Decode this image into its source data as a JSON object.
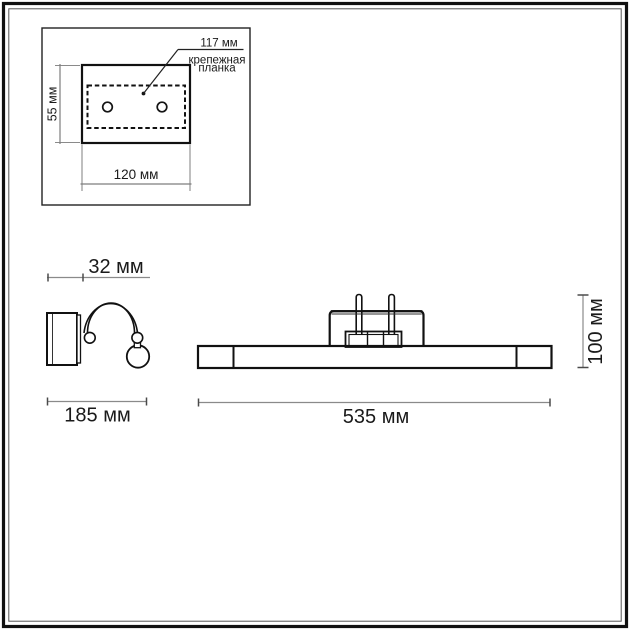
{
  "drawing": {
    "mounting_plate_view": {
      "callout_value": "117 мм",
      "callout_label_line1": "крепежная",
      "callout_label_line2": "планка",
      "height_label": "55 мм",
      "width_label": "120 мм"
    },
    "side_view": {
      "depth_label": "32 мм",
      "width_label": "185 мм"
    },
    "front_view": {
      "length_label": "535 мм",
      "height_label": "100 мм"
    },
    "dimensions_mm": {
      "plate_hole_span": 117,
      "plate_height": 55,
      "plate_width": 120,
      "side_depth": 32,
      "side_width": 185,
      "front_length": 535,
      "front_height": 100
    },
    "colors": {
      "line": "#141414",
      "dim_line": "#7d7d7d",
      "tick": "#4a4a4a",
      "text": "#1a1a1a",
      "background": "#ffffff"
    }
  }
}
